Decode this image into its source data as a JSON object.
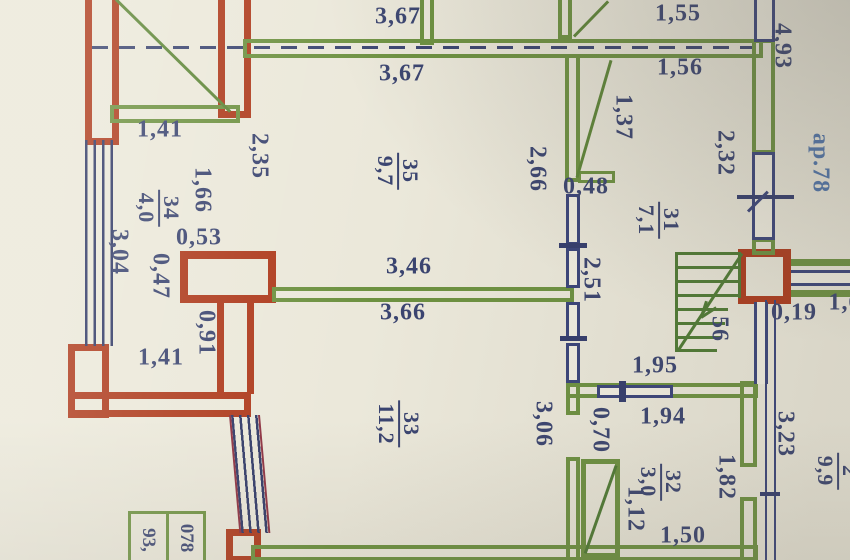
{
  "meta": {
    "type": "apartment floor plan (technical passport photo)",
    "apartment_label": "ар.78"
  },
  "colors": {
    "background": "#ebe8da",
    "brick_wall": "#ae3a1c",
    "frame_wall": "#6d9140",
    "window_line": "#39437a",
    "dim_text": "#3a4470",
    "blue_text": "#4f74ab"
  },
  "rooms": {
    "r35": {
      "num": "35",
      "area": "9,7"
    },
    "r34": {
      "num": "34",
      "area": "4,0"
    },
    "r31": {
      "num": "31",
      "area": "7,1"
    },
    "r33": {
      "num": "33",
      "area": "11,2"
    },
    "r32": {
      "num": "32",
      "area": "3,0"
    },
    "r_edge": {
      "num": "2",
      "area": "9,9"
    }
  },
  "dims": {
    "d367a": "3,67",
    "d367b": "3,67",
    "d155": "1,55",
    "d156": "1,56",
    "d493": "4,93",
    "d141a": "1,41",
    "d235": "2,35",
    "d166": "1,66",
    "d053": "0,53",
    "d047": "0,47",
    "d304": "3,04",
    "d137": "1,37",
    "d266": "2,66",
    "d048": "0,48",
    "d232": "2,32",
    "d251": "2,51",
    "d346": "3,46",
    "d366": "3,66",
    "d091": "0,91",
    "d141b": "1,41",
    "d56": "56",
    "d019": "0,19",
    "d16": "1,6",
    "d195": "1,95",
    "d194": "1,94",
    "d070": "0,70",
    "d306": "3,06",
    "d182": "1,82",
    "d112": "1,12",
    "d150": "1,50",
    "d323": "3,23"
  },
  "stamp": {
    "left": "93,",
    "right": "078"
  }
}
